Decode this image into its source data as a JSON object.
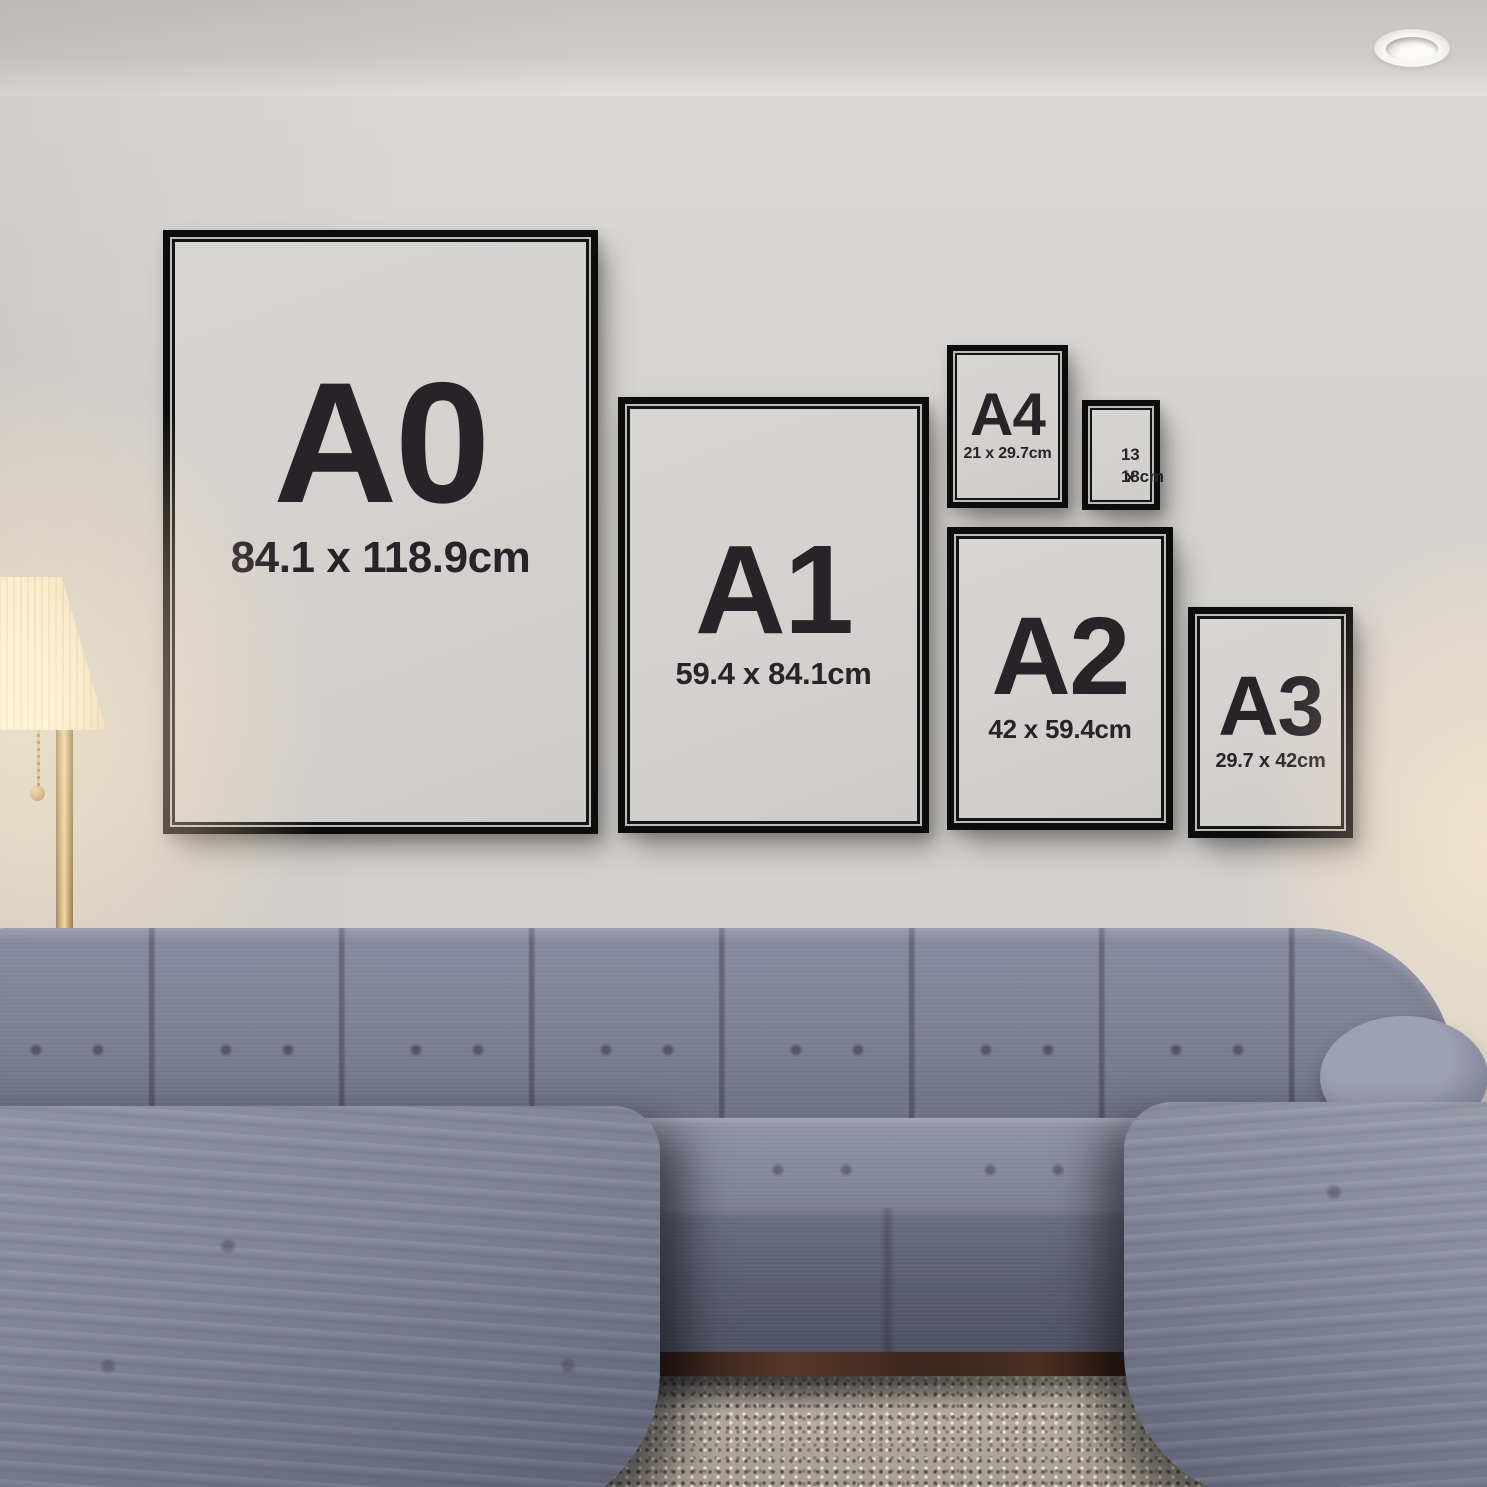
{
  "frames": [
    {
      "id": "A0",
      "label": "A0",
      "size": "84.1 x 118.9cm"
    },
    {
      "id": "A1",
      "label": "A1",
      "size": "59.4 x 84.1cm"
    },
    {
      "id": "A4",
      "label": "A4",
      "size": "21 x 29.7cm"
    },
    {
      "id": "13x18",
      "size_line1": "13 x",
      "size_line2": "18cm"
    },
    {
      "id": "A2",
      "label": "A2",
      "size": "42 x 59.4cm"
    },
    {
      "id": "A3",
      "label": "A3",
      "size": "29.7 x 42cm"
    }
  ],
  "colors": {
    "frame_black": "#0c0c0c",
    "mat_gray": "#d3d1ce",
    "label_text": "#282329",
    "wall": "#d5d3d0",
    "ceiling": "#cfcdca",
    "sofa_fabric": "#7b7e91",
    "sofa_shadow": "#585b6e",
    "rug": "#b3ab9e",
    "wood_base": "#3d261d",
    "lamp_shade": "#f8ecd2",
    "lamp_brass": "#b5934f"
  }
}
